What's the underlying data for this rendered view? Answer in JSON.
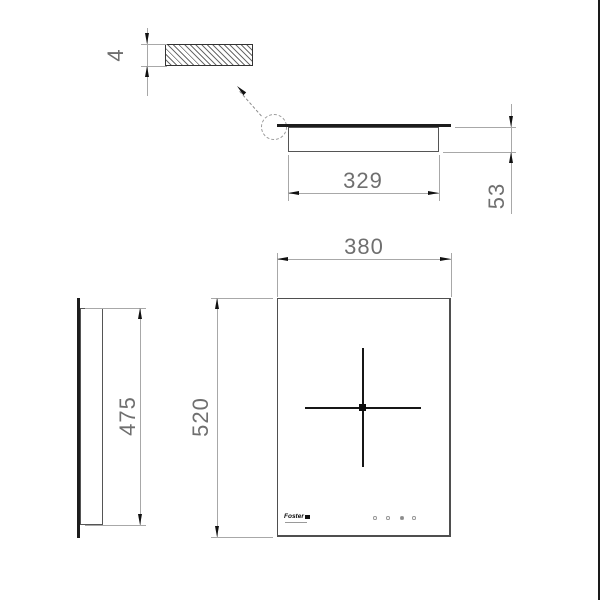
{
  "colors": {
    "background": "#ffffff",
    "object_line": "#555555",
    "thick_edge": "#1c1c1c",
    "dimension_line": "#a8a8a8",
    "dimension_text": "#6f6f6f",
    "arrow": "#111111"
  },
  "detail_view": {
    "thickness": "4"
  },
  "front_view": {
    "width": "329",
    "height": "53"
  },
  "plan_view": {
    "width": "380",
    "depth": "520",
    "brand": "Foster",
    "control_dots": 4
  },
  "side_view": {
    "height": "475"
  }
}
